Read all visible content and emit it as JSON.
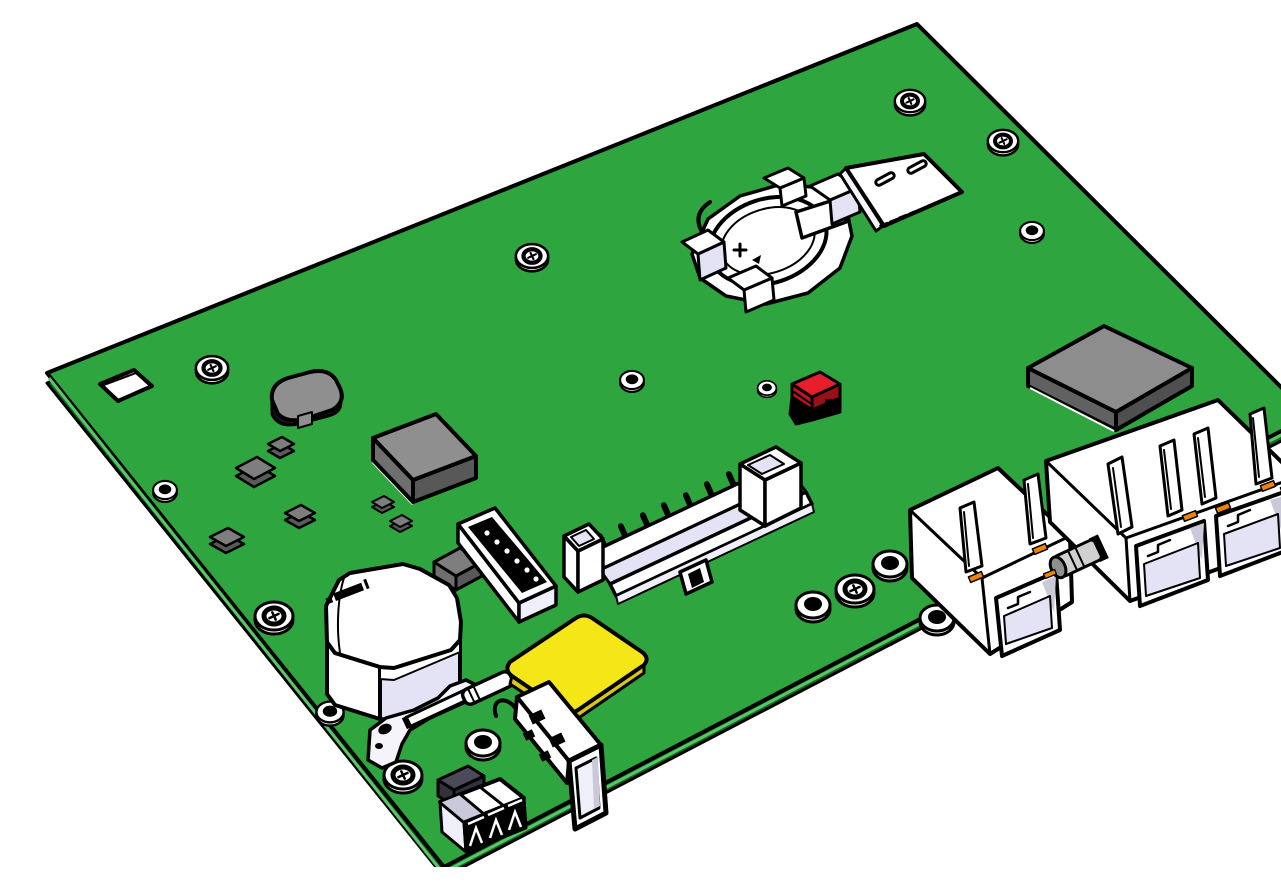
{
  "meta": {
    "type": "3d-cad-render",
    "subject": "Isometric 3D CAD rendering of a green printed circuit board assembly",
    "background": "#FFFFFF"
  },
  "colors": {
    "board_green": "#2FA53F",
    "board_edge_dark": "#14691F",
    "board_edge_strip": "#58C768",
    "outline": "#000000",
    "white": "#FFFFFF",
    "off_white": "#F4F4FA",
    "lavender": "#E3E3F5",
    "lavender_light": "#EFEFFA",
    "port_shadow": "#C9C9DA",
    "metal_gray": "#D0D0D0",
    "metal_dark": "#8F8F8F",
    "module_top": "#8D8D8D",
    "module_side": "#616161",
    "module_side_dark": "#4F4F4F",
    "chip_top": "#8F8F8F",
    "chip_side_left": "#6F6F6F",
    "chip_side_right": "#585858",
    "smd_gray": "#7E7E7E",
    "smd_side": "#5A5A5A",
    "inductor_top": "#8F8F8F",
    "inductor_body": "#161616",
    "dark_box_top": "#4A4A58",
    "dark_box_side": "#32323C",
    "yellow_top": "#F5E617",
    "yellow_side": "#D9C713",
    "red_top": "#E81E2C",
    "red_side": "#C2141F",
    "red_dark": "#9A0F18",
    "orange_led": "#F08300",
    "black": "#000000"
  },
  "components": [
    {
      "name": "pcb-board",
      "desc": "green PCB, isometric parallelogram with visible edge thickness"
    },
    {
      "name": "fiducial-window",
      "desc": "white square cutout near top-left corner"
    },
    {
      "name": "coin-cell-holder",
      "desc": "coin cell battery holder with polarity marking, upper middle"
    },
    {
      "name": "sim-card-slot",
      "desc": "micro-SIM card holder with two slots and pin row, upper right"
    },
    {
      "name": "shielded-module",
      "desc": "flat gray rectangular module, right side"
    },
    {
      "name": "red-jumper",
      "desc": "small red jumper block, center"
    },
    {
      "name": "power-inductor",
      "desc": "rounded gray-top black-body inductor, upper left"
    },
    {
      "name": "ic-chip",
      "desc": "gray cube IC, upper left"
    },
    {
      "name": "smd-chips",
      "desc": "small gray SMD passives",
      "count": 7
    },
    {
      "name": "idc-box-header",
      "desc": "shrouded two-row pin header, center"
    },
    {
      "name": "pin-header-6pin",
      "desc": "white header with black top and 6 pin holes"
    },
    {
      "name": "relay",
      "desc": "white relay cube with illegible black print, lower left"
    },
    {
      "name": "metal-bracket",
      "desc": "flat bracket with holes and lever rod"
    },
    {
      "name": "yellow-pad",
      "desc": "yellow square pad / chip, lower center"
    },
    {
      "name": "usb-a-connector",
      "desc": "metal USB-A shell with punched holes, overhanging bottom edge"
    },
    {
      "name": "terminal-block-3pos",
      "desc": "3-position connector at bottom corner"
    },
    {
      "name": "dark-module",
      "desc": "small dark slate box beside terminal block"
    },
    {
      "name": "rj45-single",
      "desc": "single RJ45 jack with latch tabs and orange LEDs"
    },
    {
      "name": "rj45-dual",
      "desc": "dual RJ45 jack with four latch tabs and orange LEDs"
    },
    {
      "name": "barrel-connector",
      "desc": "small metal barrel part between RJ45 jacks"
    },
    {
      "name": "screw-holes",
      "desc": "standoff holes with cross-head screws",
      "count": 7
    },
    {
      "name": "pad-holes",
      "desc": "plain plated standoff holes",
      "count": 9
    },
    {
      "name": "relay-top-marking",
      "desc": "illegible black printed marking on relay top"
    }
  ]
}
